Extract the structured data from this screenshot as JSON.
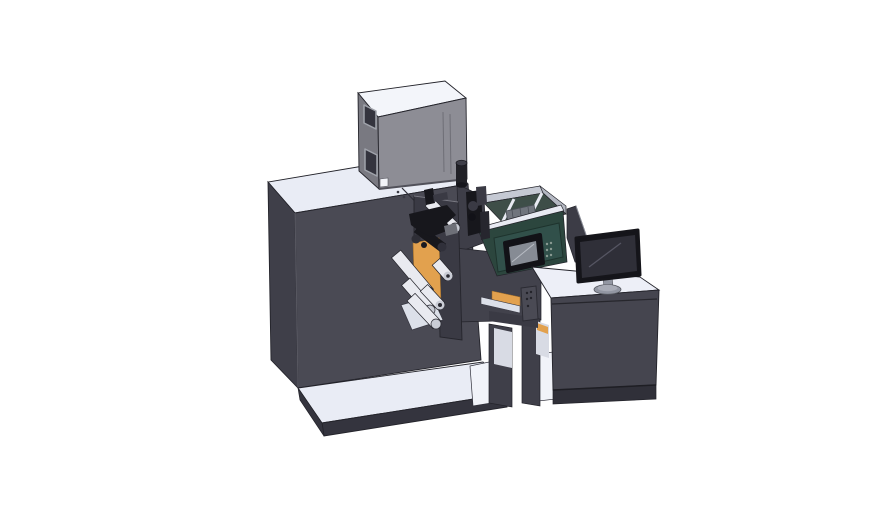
{
  "scene": {
    "type": "3d-cad-render",
    "background": "#ffffff"
  },
  "colors": {
    "machineTop": "#e9ecf5",
    "machineLeft": "#3f3f49",
    "machineFront": "#4a4a54",
    "rsDark": "#42424c",
    "rsDark2": "#3e3e48",
    "boxTop": "#f3f5fa",
    "boxFront": "#8d8d95",
    "boxLeft": "#797981",
    "boxWindow": "#34343e",
    "boxSquare": "#f2f4f9",
    "black1": "#17171c",
    "black2": "#26262e",
    "black3": "#3a3a44",
    "grayMid": "#6e7078",
    "roller": "#e9eaf0",
    "rollerCap": "#c9ccd5",
    "orange": "#e2a14e",
    "teal": "#2c463e",
    "tealHmi": "#31504a",
    "hmiBezel": "#121217",
    "hmiScreen": "#868b94",
    "hmiDot": "#8a9a92",
    "compWall": "#c5c9d3",
    "compWallR": "#b4b8c2",
    "compFloor": "#3e4e48",
    "rail": "#e8eaf2",
    "compMech": "#70757d",
    "magenta": "#c75fc5",
    "divider": "#3c3c46",
    "deskTop": "#edeff7",
    "deskFront": "#45454f",
    "deskBase": "#303039",
    "monitorBezel": "#15151a",
    "monitorScreen": "#2f2f38",
    "monitorHl": "#555562",
    "standGray": "#9296a2",
    "standGrayHi": "#a8abb6",
    "platformTop": "#e9ecf5",
    "platformFront": "#34343e",
    "doorDark": "#3a3a44",
    "whiteShelf": "#dce0e9",
    "floorWhite": "#f1f3f9",
    "legDark": "#3f3f49",
    "legLight": "#d8dbe4",
    "cylBody": "#202026",
    "cylCap": "#3e3e48"
  },
  "parts": [
    {
      "id": "machine-cabinet",
      "label": "main machine cabinet"
    },
    {
      "id": "top-electronics-box",
      "label": "electronics box on machine top"
    },
    {
      "id": "exhaust-cylinder",
      "label": "black cylinder on top surface"
    },
    {
      "id": "inner-compartment",
      "label": "open compartment with rails and print engine"
    },
    {
      "id": "hmi-panel",
      "label": "teal control panel with small screen"
    },
    {
      "id": "printhead-assembly",
      "label": "black printing mechanism"
    },
    {
      "id": "roller-assembly",
      "label": "white web rollers"
    },
    {
      "id": "orange-panel",
      "label": "orange web-guide plates"
    },
    {
      "id": "conveyor-arm",
      "label": "web path arm into desk"
    },
    {
      "id": "sensor-bracket",
      "label": "small bracket with holes"
    },
    {
      "id": "base-platform",
      "label": "floor platform step"
    },
    {
      "id": "control-desk",
      "label": "operator desk cabinet"
    },
    {
      "id": "side-panel",
      "label": "thin upright panel on desk"
    },
    {
      "id": "monitor",
      "label": "desktop monitor on stand"
    }
  ]
}
